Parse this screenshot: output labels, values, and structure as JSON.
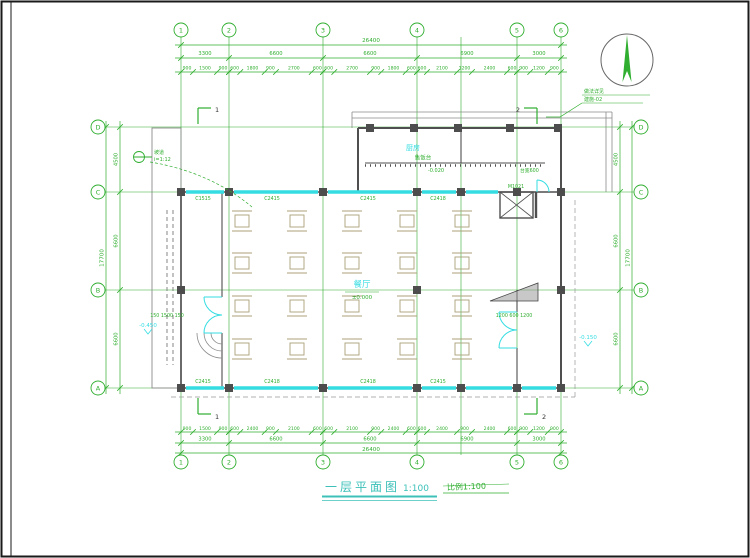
{
  "sheet": {
    "title": "一层平面图",
    "scale": "1:100",
    "stamp": "比例1:100"
  },
  "axes": {
    "cols": [
      "1",
      "2",
      "3",
      "4",
      "5",
      "6"
    ],
    "rows": [
      "D",
      "C",
      "B",
      "A"
    ]
  },
  "dims": {
    "top_total": "26400",
    "bottom_total": "26400",
    "left_total": "17700",
    "right_total": "17700",
    "top_spans": [
      "3300",
      "6600",
      "6600",
      "6900",
      "3000"
    ],
    "bottom_spans": [
      "3300",
      "6600",
      "6600",
      "6900",
      "3000"
    ],
    "left_spans": [
      "4500",
      "6600",
      "6600"
    ],
    "right_spans": [
      "4500",
      "6600",
      "6600"
    ],
    "top_detail": [
      "900",
      "1500",
      "900",
      "600",
      "1800",
      "900",
      "2700",
      "600",
      "600",
      "2700",
      "900",
      "1800",
      "600",
      "600",
      "2100",
      "1200",
      "2400",
      "600",
      "900",
      "1200",
      "900"
    ],
    "bottom_detail": [
      "900",
      "1500",
      "900",
      "600",
      "2400",
      "900",
      "2100",
      "600",
      "600",
      "2100",
      "900",
      "2400",
      "600",
      "600",
      "2400",
      "900",
      "2400",
      "600",
      "900",
      "1200",
      "900"
    ]
  },
  "rooms": {
    "dining": "餐厅",
    "dining_elev": "±0.000",
    "kitchen": "厨房",
    "kitchen_elev": "-0.020",
    "counter": "售饭台",
    "counter_note": "台宽600"
  },
  "tags": {
    "windows_top": [
      "C1515",
      "C2415",
      "C2415",
      "C2418"
    ],
    "windows_bottom": [
      "C2415",
      "C2418",
      "C2418",
      "C2415"
    ],
    "door_kitchen": "M1021",
    "door_right_dims": "1200 600 1200",
    "ramp_dims": "150 1500 150"
  },
  "marks": {
    "elev_right": "-0.150",
    "elev_left": "-0.450",
    "section_1": "1",
    "section_2": "2",
    "callout_line1": "坡道",
    "callout_line2": "i=1:12",
    "note_line1": "做法详见",
    "note_line2": "建施-02"
  },
  "colors": {
    "grid_green": "#2fae2f",
    "window_cyan": "#35dde2",
    "title_teal": "#3cc0b8",
    "wall_gray": "#4f4f4f"
  }
}
